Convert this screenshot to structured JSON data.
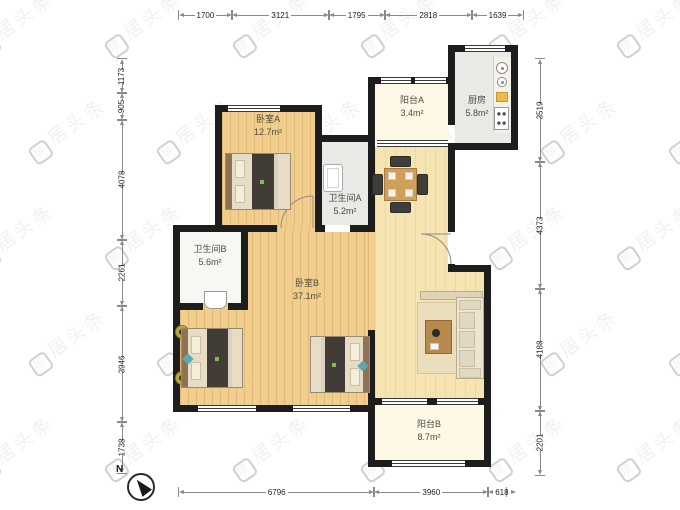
{
  "watermark": {
    "text": "居头条",
    "icon": "居"
  },
  "compass": {
    "label": "N"
  },
  "rooms": [
    {
      "id": "bedroomA",
      "name": "卧室A",
      "area": "12.7m²"
    },
    {
      "id": "bathroomA",
      "name": "卫生间A",
      "area": "5.2m²"
    },
    {
      "id": "balconyA",
      "name": "阳台A",
      "area": "3.4m²"
    },
    {
      "id": "kitchen",
      "name": "厨房",
      "area": "5.8m²"
    },
    {
      "id": "bathroomB",
      "name": "卫生间B",
      "area": "5.6m²"
    },
    {
      "id": "bedroomB",
      "name": "卧室B",
      "area": "37.1m²"
    },
    {
      "id": "balconyB",
      "name": "阳台B",
      "area": "8.7m²"
    }
  ],
  "dimensions": {
    "top": [
      "1700",
      "3121",
      "1795",
      "2818",
      "1639"
    ],
    "bottom": [
      "6796",
      "3960",
      "618"
    ],
    "left": [
      "1173",
      "905",
      "4078",
      "2261",
      "3946",
      "1738"
    ],
    "right": [
      "3519",
      "4373",
      "4188",
      "2201"
    ]
  },
  "colors": {
    "wall": "#1d1d1d",
    "wood_floor": "#F1CE8E",
    "hall_floor": "#F6E5B2",
    "balcony_floor": "#FDF9E6",
    "kitchen_floor": "#E9E9E5"
  }
}
